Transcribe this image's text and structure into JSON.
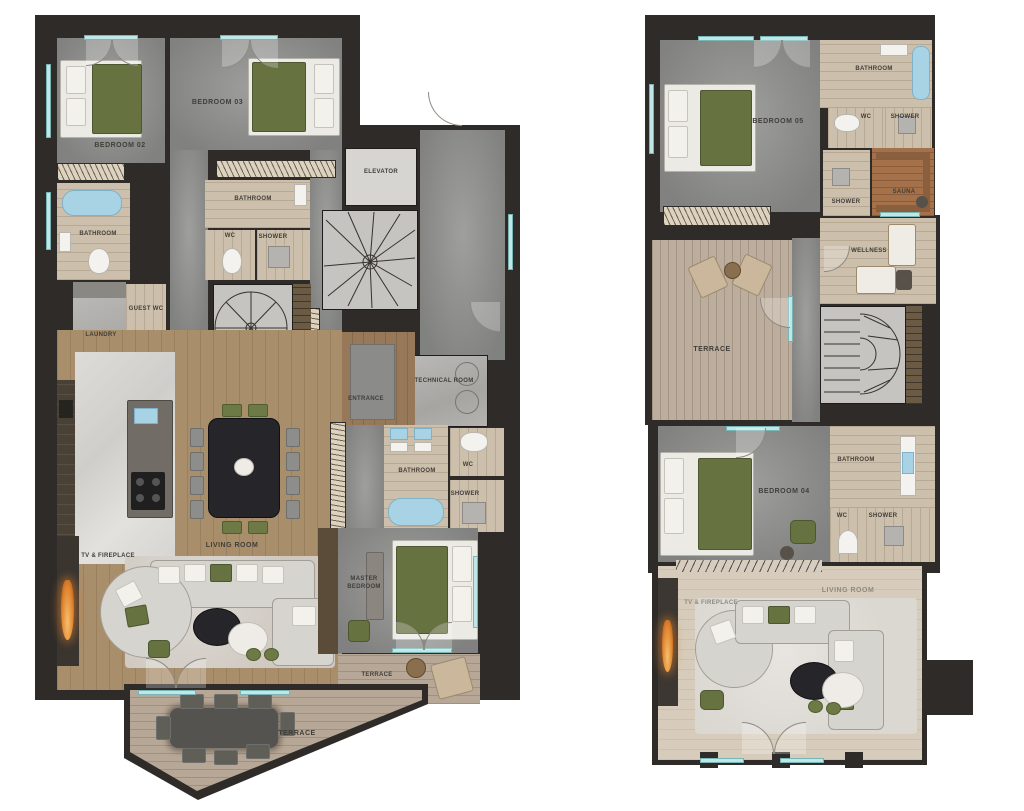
{
  "document": {
    "type": "apartment-floor-plans",
    "plan_count": 2
  },
  "colors": {
    "wall": "#2e2b28",
    "carpet_gray": "#8f908e",
    "living_wood": "#a98e6b",
    "bath_wood": "#ccbfab",
    "terrace_wood": "#b7a796",
    "sauna_wood": "#a4714a",
    "accent_green": "#66723f",
    "water_blue": "#a7d3e5",
    "fire_orange": "#e0832f",
    "window_glass": "#bfe7e7"
  },
  "plans": {
    "left": {
      "labels": {
        "bedroom02": "BEDROOM 02",
        "bathroom02": "BATHROOM",
        "bedroom03": "BEDROOM 03",
        "bathroom03": "BATHROOM",
        "wc03": "WC",
        "shower03": "SHOWER",
        "elevator": "ELEVATOR",
        "guest_wc": "GUEST WC",
        "laundry": "LAUNDRY",
        "entrance": "ENTRANCE",
        "technical_room": "TECHNICAL ROOM",
        "bathroom_master": "BATHROOM",
        "wc_master": "WC",
        "shower_master": "SHOWER",
        "living_room": "LIVING ROOM",
        "tv_fireplace": "TV & FIREPLACE",
        "master_bedroom": "MASTER BEDROOM",
        "terrace_side": "TERRACE",
        "terrace_main": "TERRACE"
      }
    },
    "right": {
      "labels": {
        "bedroom05": "BEDROOM 05",
        "bathroom05": "BATHROOM",
        "wc05": "WC",
        "shower05": "SHOWER",
        "shower_wellness": "SHOWER",
        "sauna": "SAUNA",
        "wellness": "WELLNESS",
        "terrace": "TERRACE",
        "bedroom04": "BEDROOM 04",
        "bathroom04": "BATHROOM",
        "wc04": "WC",
        "shower04": "SHOWER",
        "living_room": "LIVING ROOM",
        "tv_fireplace": "TV & FIREPLACE"
      }
    }
  }
}
